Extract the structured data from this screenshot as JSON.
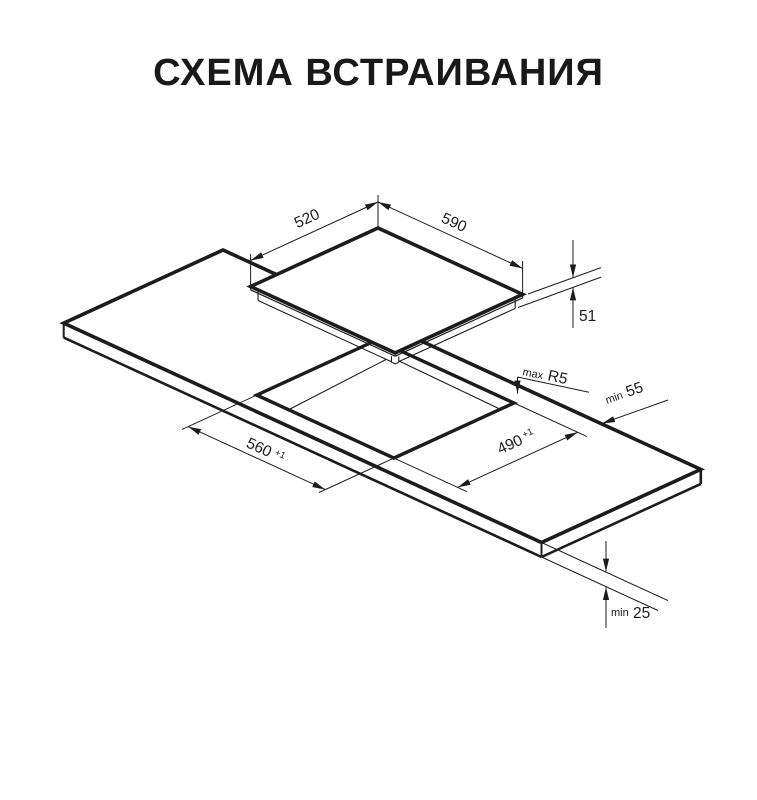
{
  "page": {
    "title": "СХЕМА ВСТРАИВАНИЯ",
    "background": "#ffffff",
    "line_color": "#1c1c1c"
  },
  "diagram": {
    "dimensions": {
      "hob_depth": {
        "value": "520"
      },
      "hob_width": {
        "value": "590"
      },
      "hob_height": {
        "value": "51"
      },
      "cutout_corner_radius": {
        "prefix": "max",
        "value": "R5"
      },
      "rear_edge_clearance": {
        "prefix": "min",
        "value": "55"
      },
      "cutout_width": {
        "value": "560",
        "tolerance": "+1"
      },
      "cutout_depth": {
        "value": "490",
        "tolerance": "+1"
      },
      "worktop_thickness": {
        "prefix": "min",
        "value": "25"
      }
    }
  }
}
